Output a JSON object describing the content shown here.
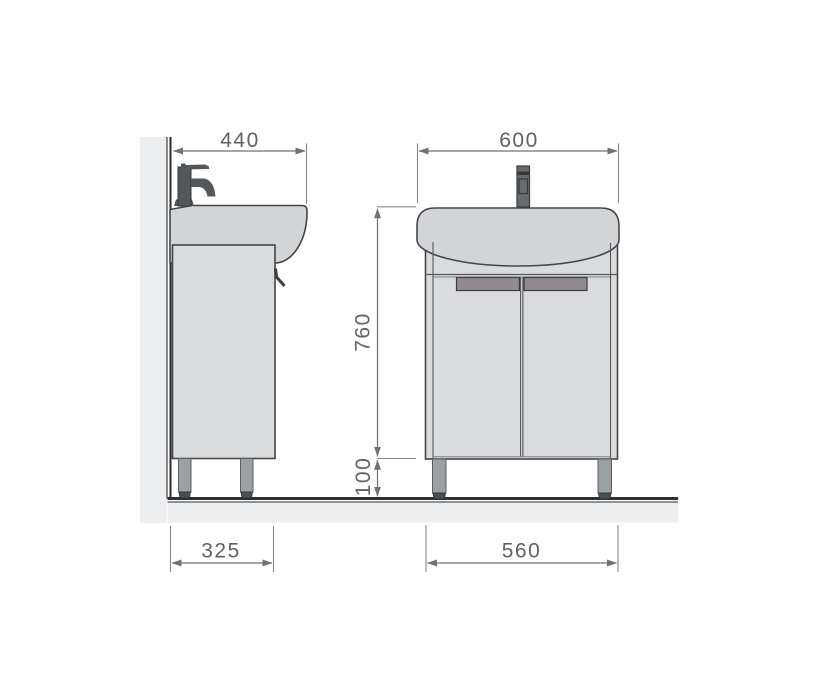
{
  "dimensions": {
    "side_top_width": "440",
    "front_top_width": "600",
    "front_height": "760",
    "front_leg_height": "100",
    "side_bottom_depth": "325",
    "front_bottom_width": "560"
  },
  "palette": {
    "background": "#ffffff",
    "wall_floor_fill": "#edeef0",
    "outline": "#43464a",
    "basin_fill": "#d3d4d6",
    "cabinet_fill": "#dadbdc",
    "handle_fill": "#918b91",
    "leg_fill": "#9ba0a3",
    "foot_fill": "#4a4e51",
    "faucet_fill": "#54575a",
    "dimension_line": "#6f7275",
    "dimension_text": "#5f6265"
  }
}
